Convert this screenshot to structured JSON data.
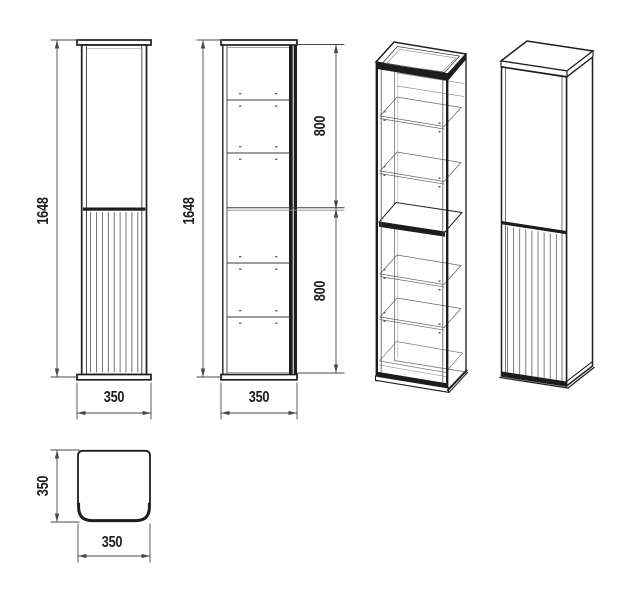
{
  "drawing": {
    "background": "#ffffff",
    "line_color": "#1d1d1f",
    "dimensions": {
      "height": "1648",
      "width": "350",
      "depth": "350",
      "shelf_section_upper": "800",
      "shelf_section_lower": "800"
    }
  }
}
